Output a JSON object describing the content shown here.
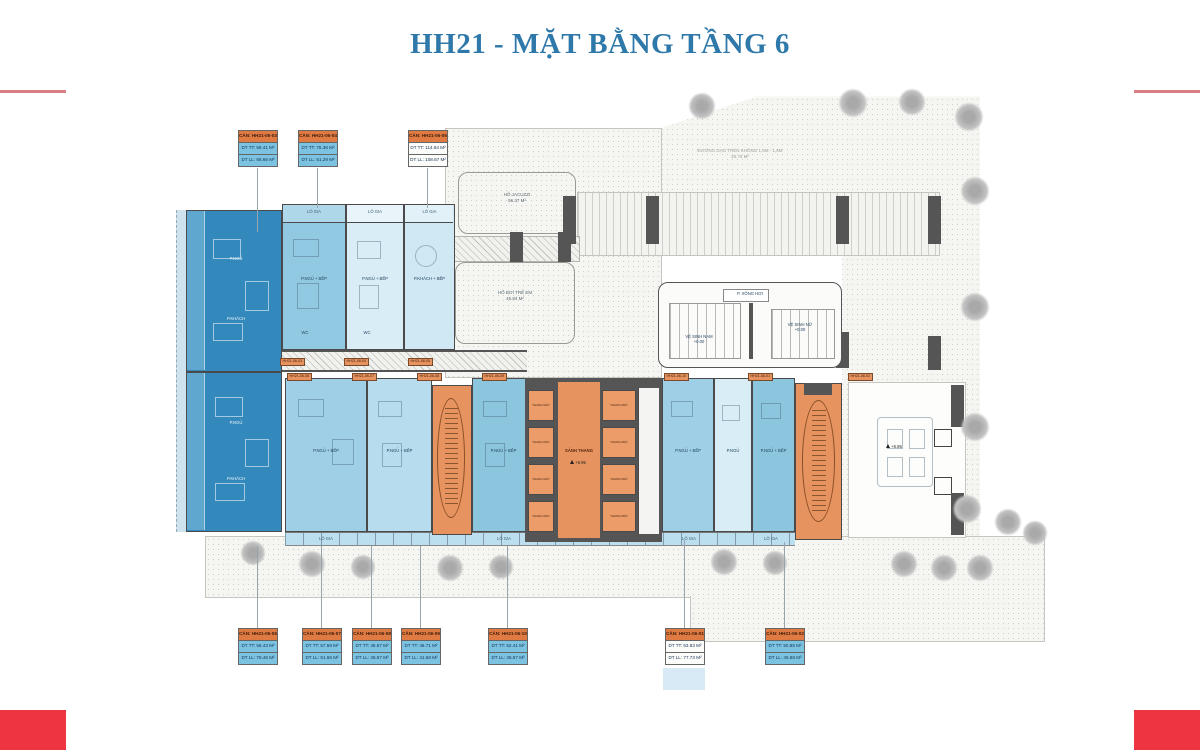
{
  "page": {
    "title": "HH21 - MẶT BẰNG TẦNG 6"
  },
  "colors": {
    "accent_red": "#ed3440",
    "title_blue": "#2e78aa",
    "dark_unit_blue": "#3489bc",
    "medium_unit_blue": "#92c9e2",
    "pale_unit_blue": "#d9edf6",
    "core_orange": "#e6935f",
    "callout_header_orange": "#e07a43",
    "callout_body_blue": "#7cc3e2",
    "wall_gray": "#555555"
  },
  "callouts": {
    "top": [
      {
        "unit": "CĂN: HH21-06-03",
        "tt": "DT TT: 59.41 M²",
        "ll": "DT LL: 66.66 M²"
      },
      {
        "unit": "CĂN: HH21-06-04",
        "tt": "DT TT: 75.36 M²",
        "ll": "DT LL: 51.29 M²"
      },
      {
        "unit": "CĂN: HH21-06-05",
        "tt": "DT TT: 114.84 M²",
        "ll": "DT LL: 108.67 M²"
      }
    ],
    "bottom": [
      {
        "unit": "CĂN: HH21-06-06",
        "tt": "DT TT: 56.43 M²",
        "ll": "DT LL: 78.46 M²"
      },
      {
        "unit": "CĂN: HH21-06-07",
        "tt": "DT TT: 57.58 M²",
        "ll": "DT LL: 51.66 M²"
      },
      {
        "unit": "CĂN: HH21-06-08",
        "tt": "DT TT: 46.87 M²",
        "ll": "DT LL: 45.87 M²"
      },
      {
        "unit": "CĂN: HH21-06-09",
        "tt": "DT TT: 46.71 M²",
        "ll": "DT LL: 41.58 M²"
      },
      {
        "unit": "CĂN: HH21-06-10",
        "tt": "DT TT: 52.41 M²",
        "ll": "DT LL: 45.87 M²"
      },
      {
        "unit": "CĂN: HH21-06-01",
        "tt": "DT TT: 63.83 M²",
        "ll": "DT LL: 77.73 M²"
      },
      {
        "unit": "CĂN: HH21-06-02",
        "tt": "DT TT: 50.85 M²",
        "ll": "DT LL: 45.88 M²"
      }
    ]
  },
  "plan": {
    "pools": [
      {
        "name": "HỒ JACUZZI",
        "area": "56.37 M²"
      },
      {
        "name": "HỒ BƠI TRẺ EM",
        "area": "45.84 M²"
      }
    ],
    "terrace_note": {
      "line1": "ĐƯỜNG DẠO TRÊN KHÔNG 1,6M - 1,8M",
      "line2": "26.79 M²"
    },
    "core": {
      "lobby": "SẢNH THANG",
      "level": "+6.95",
      "lift": "THANG MÁY"
    },
    "wc": {
      "male": "VỆ SINH NAM",
      "female": "VỆ SINH NỮ",
      "sauna": "P. XÔNG HƠI",
      "level": "+0.00"
    },
    "rooms": {
      "bedroom_kitchen": "P.NGỦ + BẾP",
      "living_kitchen": "P.KHÁCH + BẾP",
      "bedroom": "P.NGỦ",
      "living": "P.KHÁCH",
      "wc": "WC",
      "loggia": "LÔ GIA"
    },
    "tags": [
      "HH21-06-03",
      "HH21-06-04",
      "HH21-06-05",
      "HH21-06-06",
      "HH21-06-07",
      "HH21-06-08",
      "HH21-06-09",
      "HH21-06-10",
      "HH21-06-01",
      "HH21-06-02"
    ]
  }
}
